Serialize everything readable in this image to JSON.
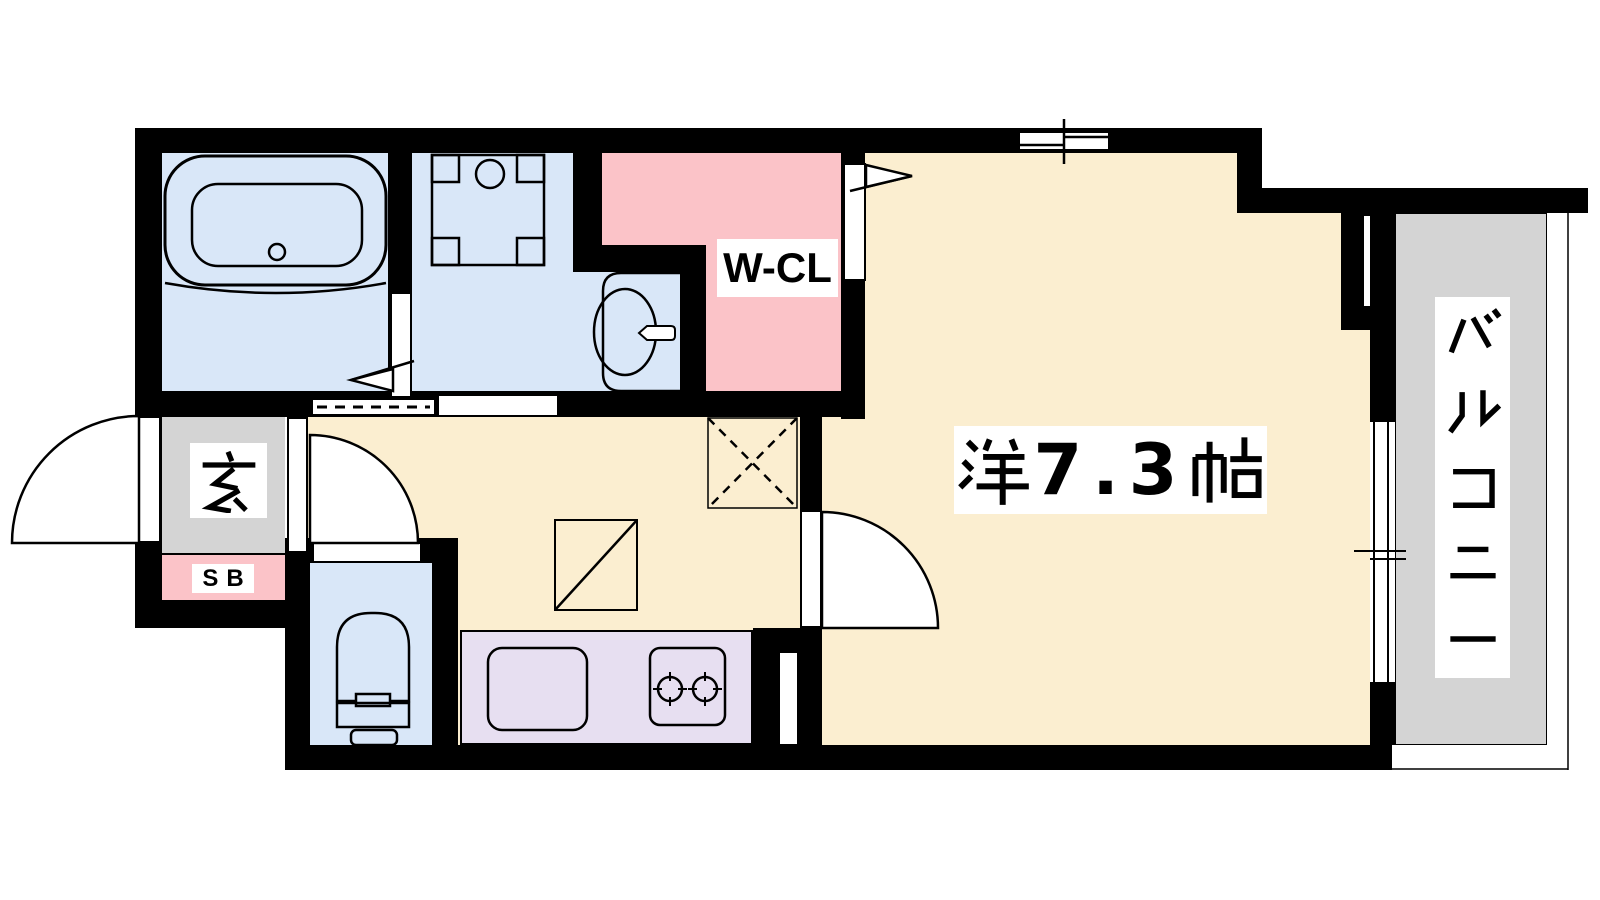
{
  "floor_plan": {
    "type": "apartment-floor-plan-1K",
    "labels": {
      "main_room": "洋7.3帖",
      "main_room_digits": "7.3",
      "walk_in_closet": "W-CL",
      "entrance": "玄",
      "shoe_box": "SB",
      "balcony": "バルコニー"
    },
    "rooms": [
      {
        "name": "western-room",
        "label": "洋7.3帖",
        "color": "#FBEED0"
      },
      {
        "name": "kitchen-hall",
        "label": "",
        "color": "#FBEED0"
      },
      {
        "name": "walk-in-closet",
        "label": "W-CL",
        "color": "#FBC3C8"
      },
      {
        "name": "bathroom",
        "label": "",
        "color": "#D9E7F8"
      },
      {
        "name": "washroom",
        "label": "",
        "color": "#D9E7F8"
      },
      {
        "name": "toilet",
        "label": "",
        "color": "#D9E7F8"
      },
      {
        "name": "kitchen-counter",
        "label": "",
        "color": "#E7DFF1"
      },
      {
        "name": "entrance",
        "label": "玄",
        "color": "#D4D4D4"
      },
      {
        "name": "shoe-box",
        "label": "SB",
        "color": "#FBC3C8"
      },
      {
        "name": "balcony",
        "label": "バルコニー",
        "color": "#D4D4D4"
      }
    ],
    "fixtures": [
      "bathtub",
      "washing-machine-pan",
      "washbasin",
      "toilet-bowl",
      "kitchen-sink",
      "gas-stove-2-burner",
      "refrigerator-space-dashed-x",
      "appliance-space-diagonal",
      "sliding-window-top",
      "sliding-window-balcony",
      "hinged-door-entrance",
      "hinged-door-hall",
      "hinged-door-main-room",
      "sliding-door-washroom",
      "folding-door-bathroom",
      "folding-door-closet"
    ],
    "colors": {
      "wall": "#000000",
      "background": "#FFFFFF",
      "room_cream": "#FBEED0",
      "wet_area_blue": "#D9E7F8",
      "closet_pink": "#FBC3C8",
      "kitchen_lavender": "#E7DFF1",
      "entrance_gray": "#D4D4D4",
      "balcony_gray": "#D4D4D4"
    }
  }
}
